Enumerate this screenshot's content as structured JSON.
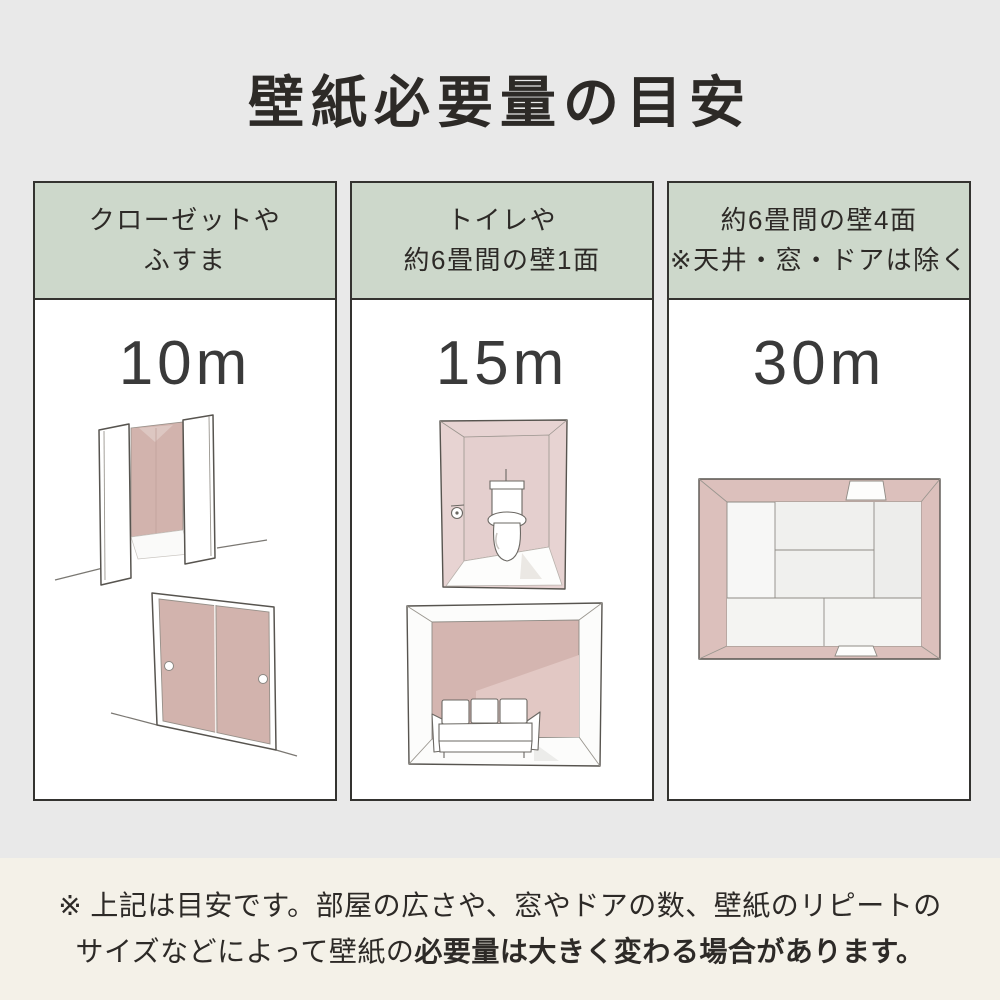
{
  "title": "壁紙必要量の目安",
  "colors": {
    "page_background": "#e9e9e9",
    "note_background": "#f4f1e8",
    "header_green": "#cdd8cb",
    "panel_white": "#ffffff",
    "panel_border": "#343330",
    "text_dark": "#2d2a27",
    "accent_pink": "#d2b3ad",
    "light_pink": "#e7d3d2",
    "topview_wall_pink": "#dcc0bc"
  },
  "panels": [
    {
      "header_line1": "クローゼットや",
      "header_line2": "ふすま",
      "value": "10m",
      "illustration_names": "closet-illustration, fusuma-illustration"
    },
    {
      "header_line1": "トイレや",
      "header_line2": "約6畳間の壁1面",
      "value": "15m",
      "illustration_names": "toilet-room-illustration, living-room-illustration"
    },
    {
      "header_line1": "約6畳間の壁4面",
      "header_line2": "※天井・窓・ドアは除く",
      "value": "30m",
      "illustration_names": "room-topview-illustration"
    }
  ],
  "note": {
    "line1": "※ 上記は目安です。部屋の広さや、窓やドアの数、壁紙のリピートの",
    "line2_normal": "サイズなどによって壁紙の",
    "line2_bold": "必要量は大きく変わる場合があります。"
  }
}
